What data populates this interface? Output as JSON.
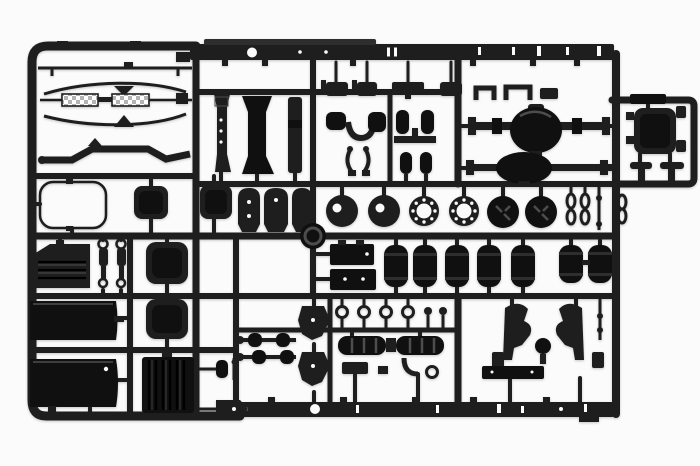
{
  "scene": {
    "type": "photograph",
    "description": "Black injection-molded plastic model-kit sprue (parts tree) with truck chassis components on a white background",
    "background_color": "#fbfbfb",
    "plastic_color": "#1e1e1e"
  },
  "colors": {
    "bg": "#fbfbfb",
    "plastic": "#1e1e1e",
    "plastic-dark": "#101010",
    "plastic-mid": "#2e2e2e",
    "highlight": "#4d4d4d",
    "checker-grey": "#b4b4b4",
    "checker-light": "#ffffff"
  },
  "parts_inventory": [
    {
      "id": "chassis-rail-top",
      "label": "chassis side rail (top of sprue)",
      "count": 1
    },
    {
      "id": "chassis-rail-bottom",
      "label": "chassis side rail (bottom of sprue)",
      "count": 1
    },
    {
      "id": "stabilizer-bars",
      "label": "thin stabilizer / linkage bars",
      "count": 4
    },
    {
      "id": "diamond-plate-steps",
      "label": "checker-plate catwalk steps",
      "count": 2
    },
    {
      "id": "cab-pillars",
      "label": "vertical chassis cross members",
      "count": 3
    },
    {
      "id": "flat-brackets",
      "label": "flat mounting bracket plates",
      "count": 3
    },
    {
      "id": "wire-loop",
      "label": "thin wire frame loop",
      "count": 1
    },
    {
      "id": "tank-end-caps",
      "label": "rounded fuel-tank end caps",
      "count": 4
    },
    {
      "id": "rear-axle-housings",
      "label": "rear axle housings with differential",
      "count": 2
    },
    {
      "id": "brake-discs",
      "label": "brake discs with offset hole",
      "count": 2
    },
    {
      "id": "rim-rings",
      "label": "wheel rim rings with bolt holes",
      "count": 2
    },
    {
      "id": "wheel-hubs",
      "label": "dark wheel hubs / drums",
      "count": 2
    },
    {
      "id": "battery-boxes",
      "label": "battery / tool boxes",
      "count": 2
    },
    {
      "id": "air-tanks",
      "label": "ribbed air reservoir cylinders",
      "count": 7
    },
    {
      "id": "mufflers",
      "label": "ribbed exhaust mufflers",
      "count": 2
    },
    {
      "id": "torque-rods",
      "label": "torque rods with bushings",
      "count": 2
    },
    {
      "id": "spring-hangers",
      "label": "spade-shaped spring hangers",
      "count": 2
    },
    {
      "id": "eye-rings",
      "label": "small eye-ring fittings",
      "count": 4
    },
    {
      "id": "cab-mount-brackets",
      "label": "mirrored cab mount brackets",
      "count": 2
    },
    {
      "id": "louvered-panel",
      "label": "louvered side panel",
      "count": 1
    },
    {
      "id": "shock-absorbers",
      "label": "shock absorbers",
      "count": 2
    },
    {
      "id": "fuel-tank-panels",
      "label": "large fuel tank wrapper panels",
      "count": 2
    },
    {
      "id": "radiator-grille",
      "label": "ribbed radiator core",
      "count": 1
    },
    {
      "id": "engine-mount-cluster",
      "label": "small engine/cab mount fittings",
      "count": 12
    },
    {
      "id": "cab-box",
      "label": "boxed component in right extension",
      "count": 1
    },
    {
      "id": "t-mounts",
      "label": "T-shaped mounts",
      "count": 2
    }
  ]
}
